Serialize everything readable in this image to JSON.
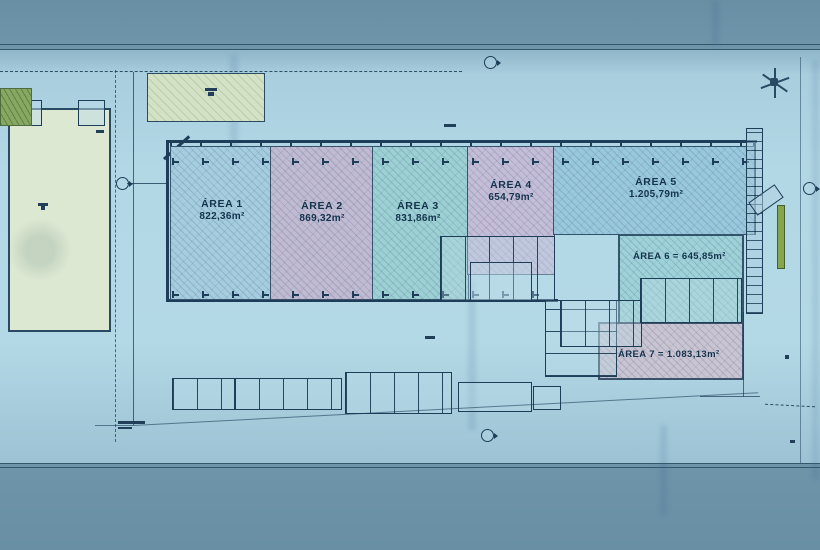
{
  "plan": {
    "areas": [
      {
        "label": "ÁREA 1",
        "value": "822,36m²"
      },
      {
        "label": "ÁREA 2",
        "value": "869,32m²"
      },
      {
        "label": "ÁREA 3",
        "value": "831,86m²"
      },
      {
        "label": "ÁREA 4",
        "value": "654,79m²"
      },
      {
        "label": "ÁREA 5",
        "value": "1.205,79m²"
      }
    ],
    "inline_areas": [
      {
        "text": "ÁREA 6 = 645,85m²"
      },
      {
        "text": "ÁREA 7 = 1.083,13m²"
      }
    ],
    "colors": {
      "photo_background": "#6d94a9",
      "paper": "#b2d7e5",
      "ink": "#1e3d58",
      "area1_fill": "#a6cddf",
      "area2_fill": "#c0bad2",
      "area3_fill": "#9cd0d4",
      "area4_fill": "#c4bdd7",
      "area5_fill": "#99c8dc",
      "area6_fill": "#9fd2d8",
      "area7_fill": "#c9c4d2",
      "plot_fill": "#dde8d2",
      "green_accent": "#87a44e"
    }
  }
}
